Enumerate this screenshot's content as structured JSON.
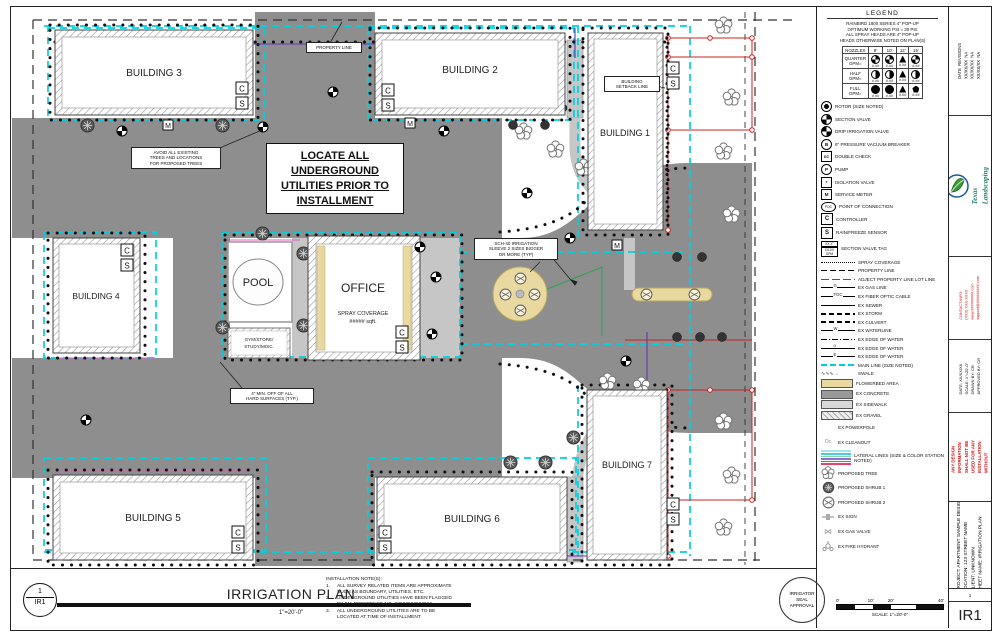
{
  "colors": {
    "road": "#8e8e8e",
    "walk": "#c6c6c6",
    "main_line": "#00cfe0",
    "flowerbed": "#e9d9a0",
    "red": "#cc2222",
    "magenta": "#e060c0",
    "purple": "#6633bb",
    "green": "#33a055",
    "lateral_stack": [
      "#9fe8ef",
      "#49cbe0",
      "#86d7a2",
      "#8e6fd8",
      "#b13fd8",
      "#e8416b"
    ]
  },
  "plan": {
    "buildings": [
      "BUILDING 1",
      "BUILDING 2",
      "BUILDING 3",
      "BUILDING 4",
      "BUILDING 5",
      "BUILDING 6",
      "BUILDING 7"
    ],
    "pool": "POOL",
    "office": "OFFICE",
    "office_sub": [
      "SPRAY COVERAGE",
      "##### sqft."
    ],
    "gym": [
      "GYM/STORE/",
      "STUDY/MISC."
    ],
    "c": "C",
    "s": "S",
    "m": "M",
    "callouts": {
      "property": "PROPERTY LINE",
      "setback": [
        "BUILDING",
        "SETBACK LINE"
      ],
      "avoid": [
        "AVOID ALL EXISTING",
        "TREES AND LOCATIONS",
        "FOR PROPOSED TREES"
      ],
      "locate": [
        "LOCATE ALL",
        "UNDERGROUND",
        "UTILITIES  PRIOR TO",
        "INSTALLMENT"
      ],
      "sleeve": [
        "SCH-40 IRRIGATION",
        "SLEEVE 2 SIZES BIGGER",
        "OR MORE (TYP)"
      ],
      "hard": [
        "4\" MIN. OFF OF ALL",
        "HARD SURFACES (TYP.)"
      ]
    }
  },
  "legend": {
    "title": "LEGEND",
    "header_lines": [
      "RAINBIRD 1800 SERIES 4\" POP-UP",
      "OPTIMUM WORKING PSI = 30 PSI",
      "ALL SPRAY HEADS ARE 4\" POP-UP",
      "HEADS OTHERWISE NOTED ON PLAN(S)"
    ],
    "nozzle_table": {
      "col_headers": [
        "NOZZLES",
        "8'",
        "10'",
        "12'",
        "15'"
      ],
      "row_labels": [
        "QUARTER",
        "HALF",
        "FULL"
      ],
      "gpm_label": "GPM=",
      "gpm_mask": "#.##"
    },
    "symbols": [
      {
        "label": "ROTOR (SIZE NOTED)"
      },
      {
        "label": "SECTION VALVE"
      },
      {
        "label": "DRIP IRRIGATION VALVE"
      },
      {
        "label": "6\" PRESSURE VACUUM BREAKER",
        "glyph": "B"
      },
      {
        "label": "DOUBLE CHECK",
        "glyph": "DC"
      },
      {
        "label": "PUMP",
        "glyph": "P"
      },
      {
        "label": "ISOLATION VALVE",
        "glyph": "*"
      },
      {
        "label": "SERVICE METER",
        "glyph": "M"
      },
      {
        "label": "POINT OF CONNECTION",
        "glyph": "POC"
      },
      {
        "label": "CONTROLLER",
        "glyph": "C"
      },
      {
        "label": "RAIN/FREEZE SENSOR",
        "glyph": "S"
      },
      {
        "label": "SECTION VALVE TAG",
        "tag1": "XX X\"",
        "tag2": "XX.XX GPM"
      }
    ],
    "lines": [
      {
        "label": "SPRAY COVERAGE"
      },
      {
        "label": "PROPERTY LINE"
      },
      {
        "label": "ADJECT PROPERTY LINE LOT LINE"
      },
      {
        "label": "EX GAS LINE",
        "marker": "G"
      },
      {
        "label": "EX FIBER OPTIC CABLE",
        "marker": "FOC"
      },
      {
        "label": "EX SEWER"
      },
      {
        "label": "EX STORM"
      },
      {
        "label": "EX CULVERT"
      },
      {
        "label": "EX WATERLINE",
        "marker": "W"
      },
      {
        "label": "EX EDGE OF WATER"
      },
      {
        "label": "EX EDGE OF WATER",
        "marker": "o"
      },
      {
        "label": "EX EDGE OF WATER",
        "marker": "E"
      },
      {
        "label": "MAIN LINE (SIZE NOTED)"
      },
      {
        "label": "SWALE",
        "glyph": "∿∿∿→"
      }
    ],
    "areas": [
      {
        "label": "FLOWERBED AREA"
      },
      {
        "label": "EX CONCRETE"
      },
      {
        "label": "EX SIDEWALK"
      },
      {
        "label": "EX GRAVEL"
      }
    ],
    "misc": [
      {
        "label": "EX POWERPOLE"
      },
      {
        "label": "EX CLEANOUT",
        "glyph": "Oc"
      },
      {
        "label": "LATERAL LINES (SIZE & COLOR STATION NOTED)"
      },
      {
        "label": "PROPOSED TREE"
      },
      {
        "label": "PROPOSED SHRUB 1"
      },
      {
        "label": "PROPOSED SHRUB 2"
      },
      {
        "label": "EX SIGN"
      },
      {
        "label": "EX GAS VALVE",
        "glyph": "⋈"
      },
      {
        "label": "EX FIRE HYDRANT"
      }
    ]
  },
  "titleblock": {
    "revisions": "DATE  REVISIONS\nXX/XX/XX  NA\nXX/XX/XX  NA\nXX/XX/XX  NA",
    "copyright": "Copyright © Texas Landscaping Resources",
    "company": "Texas\nLandscaping\nResources",
    "contact": "CONTACT INFO:\n(XXX) XXX-XXXX\nwww.#########.com\nsupport@#########.com",
    "meta": "DATE: XX/XX/XX\nSCALE: 1\"=20'-0\"\nDRAWN BY: CR\nAPPROVED BY: CR",
    "disclaimer": "PRELIMINARY:\nANY DESIGN\nINFORMATION\nSHALL NOT BE\nUSED FOR ANY\nINSTALLATION\nWITHOUT\nAPPROVAL",
    "project": "PROJECT: APARTMENT SAMPLE DESIGN\nLOCATION: 123 STREET NAME\nCLIENT: UNKNOWN\nSHEET NAME: IRRIGATION PLAN",
    "sheet_small": "1",
    "sheet_no": "IR1"
  },
  "footer": {
    "bubble_num": "1",
    "bubble_sheet": "IR1",
    "title": "IRRIGATION PLAN",
    "scale": "1\"=20'-0\"",
    "notes_title": "INSTALLATION NOTE(S):",
    "notes": [
      {
        "n": "1.",
        "l1": "ALL SURVEY RELATED ITEMS ARE APPROXIMATE",
        "l2": "SUCH AS BOUNDARY, UTILITIES, ETC."
      },
      {
        "n": "2.",
        "l1": "UNDERGROUND UTILITIES HAVE BEEN FLAGGED",
        "l2": "BY 811 REFERENCE NO. ##############"
      },
      {
        "n": "3.",
        "l1": "ALL UNDERGROUND UTILITIES ARE TO BE",
        "l2": "LOCATED AT TIME OF INSTALLMENT"
      }
    ],
    "seal": [
      "IRRIGATOR",
      "SEAL",
      "APPROVAL"
    ],
    "scalebar": {
      "t0": "0'",
      "t1": "10'",
      "t2": "20'",
      "t3": "40'",
      "caption": "SCALE: 1\"=20'-0\""
    },
    "compass": {
      "n": "N",
      "s": "S",
      "e": "E",
      "w": "W"
    }
  }
}
